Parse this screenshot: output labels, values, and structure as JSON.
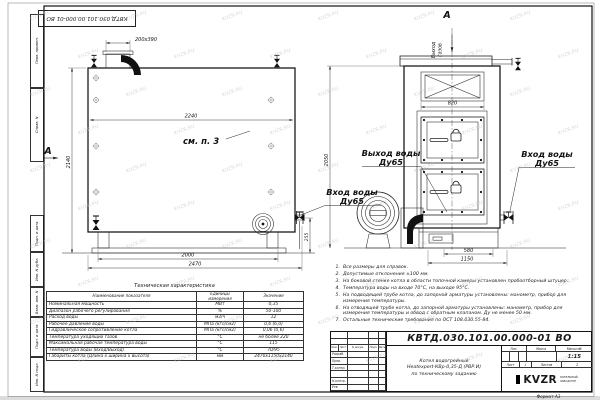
{
  "sheet": {
    "doc_number": "КВТД.030.101.00.000-01 ВО",
    "format": "Формат А3",
    "watermark": "KVZR.RU",
    "margin_labels_top": [
      "Перв. примен.",
      "Справ. N"
    ],
    "margin_labels_bottom": [
      "Подп. и дата",
      "Инв. N дубл.",
      "Взам. инв. N",
      "Подп. и дата",
      "Инв. N подл."
    ]
  },
  "side_view": {
    "section_label": "А",
    "see_note": "см. п. 3",
    "dim_flue": "200х390",
    "dim_width_inner": "2240",
    "dim_height": "2140",
    "dim_base": "2000",
    "dim_length": "2470",
    "dim_valve_height": "255"
  },
  "front_view": {
    "section_label": "А",
    "label_gas_out_1": "Выход",
    "label_gas_out_2": "газов",
    "dim_hatch": "820",
    "dim_height": "2050",
    "dim_base": "580",
    "dim_width": "1150",
    "label_water_out": "Выход воды",
    "label_water_out_dn": "Ду65",
    "label_water_in_left": "Вход воды",
    "label_water_in_left_dn": "Ду65",
    "label_water_in_right": "Вход воды",
    "label_water_in_right_dn": "Ду65"
  },
  "notes": [
    "Все размеры для справок.",
    "Допустимые отклонения ±100 мм.",
    "На боковой стенке котла в области топочной камеры установлен пробоотборный штуцер.",
    "Температура воды на входе 70°С, на выходе 95°С.",
    "На подводящей трубе котла, до запорной арматуры установлены: манометр, прибор для измерения температуры.",
    "На отводящей трубе котла, до запорной арматуры установлены: манометр, прибор для измерения температуры и обвод с обратным клапаном. Ду не менее 50 мм.",
    "Остальные технические требования по ОСТ 108.030.55-84."
  ],
  "tech_table": {
    "title": "Техническая характеристика",
    "headers": [
      "Наименование показателя",
      "Единицы\nизмерения",
      "Значение"
    ],
    "rows": [
      [
        "Номинальная мощность",
        "МВт",
        "0,35"
      ],
      [
        "Диапазон рабочего регулирования",
        "%",
        "50-100"
      ],
      [
        "Расход воды",
        "м3/ч",
        "12"
      ],
      [
        "Рабочее давление воды",
        "МПа (кгс/см2)",
        "0,6 (6,0)"
      ],
      [
        "Гидравлическое сопротивление котла",
        "МПа (кгс/см2)",
        "0,06 (0,6)"
      ],
      [
        "Температура уходящих газов",
        "°С",
        "не более 220"
      ],
      [
        "Максимальная рабочая температура воды",
        "°С",
        "115"
      ],
      [
        "Температура воды (Вход/Выход)",
        "°С",
        "70/95"
      ],
      [
        "Габариты котла (Длина х ширина х высота)",
        "мм",
        "2470х1150х2140"
      ]
    ]
  },
  "title_block": {
    "doc_number": "КВТД.030.101.00.000-01 ВО",
    "product_title": [
      "Котел водогрейный",
      "Heatexpert-КВр-0,35-Д (РВР.И)",
      "по техническому заданию"
    ],
    "header_cells": [
      "Изм.",
      "Лист",
      "N докум.",
      "Подп.",
      "Дата"
    ],
    "row_labels": [
      "Разраб.",
      "Пров.",
      "Т.контр.",
      "",
      "Н.контр.",
      "Утв."
    ],
    "lit_label": "Лит.",
    "mass_label": "Масса",
    "scale_label": "Масштаб",
    "scale_value": "1:15",
    "sheet_label": "Лист",
    "sheet_value": "1",
    "sheets_label": "Листов",
    "sheets_value": "2",
    "logo_text": "KVZR",
    "logo_caption_1": "КОТЕЛЬНЫЙ",
    "logo_caption_2": "ЗАВОД РЭП"
  }
}
